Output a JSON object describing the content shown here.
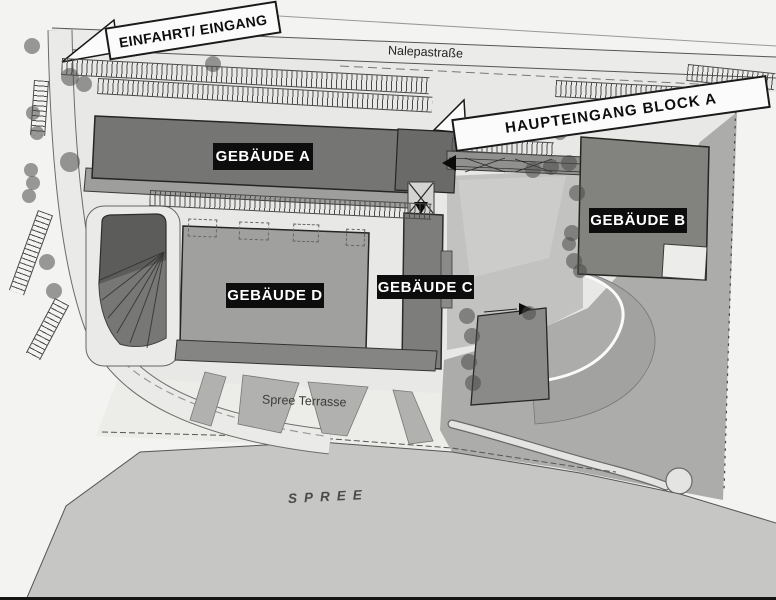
{
  "street": {
    "name": "Nalepastraße"
  },
  "river": {
    "name": "SPREE"
  },
  "terrace": {
    "name": "Spree Terrasse"
  },
  "callouts": {
    "entrance": "EINFAHRT/ EINGANG",
    "main_entrance_block_a": "HAUPTEINGANG BLOCK A"
  },
  "buildings": {
    "a": {
      "label": "GEBÄUDE A"
    },
    "b": {
      "label": "GEBÄUDE B"
    },
    "c": {
      "label": "GEBÄUDE C"
    },
    "d": {
      "label": "GEBÄUDE D"
    }
  },
  "colors": {
    "ground": "#e8e8e6",
    "bank": "#acacaa",
    "river": "#c6c6c4",
    "building_dark": "#757573",
    "building_b": "#82827f",
    "building_c": "#7d7d7b",
    "building_medium": "#a0a09e",
    "label_bg": "#0d0d0d",
    "label_text": "#ffffff",
    "callout_bg": "#fbfbfb",
    "callout_border": "#1a1a1a"
  }
}
